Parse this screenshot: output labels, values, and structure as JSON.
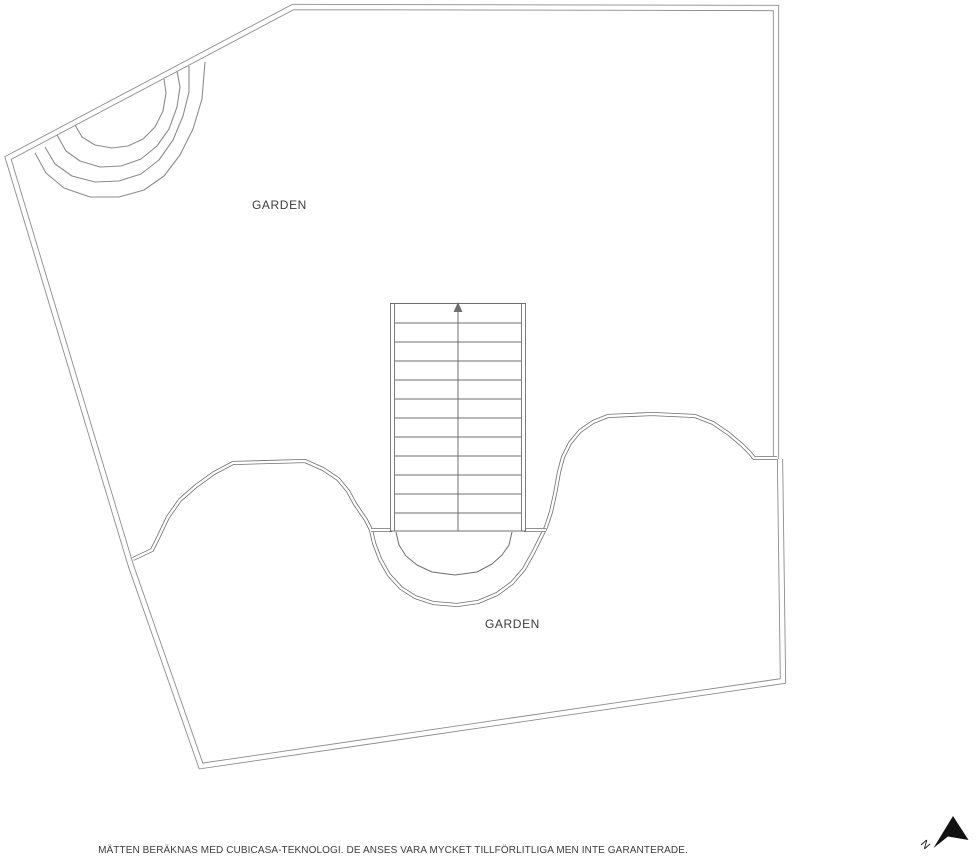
{
  "plan": {
    "labels": {
      "garden_upper": "GARDEN",
      "garden_lower": "GARDEN"
    },
    "stairs": {
      "tread_count": 11,
      "direction": "up"
    },
    "compass": {
      "label": "N"
    },
    "disclaimer": "MÄTTEN BERÄKNAS MED CUBICASA-TEKNOLOGI. DE ANSES VARA MYCKET TILLFÖRLITLIGA MEN INTE GARANTERADE.",
    "colors": {
      "background": "#ffffff",
      "wall_line": "#8c8c8c",
      "detail_line": "#6f6f6f",
      "text": "#3c3c3c",
      "compass": "#111111"
    }
  }
}
